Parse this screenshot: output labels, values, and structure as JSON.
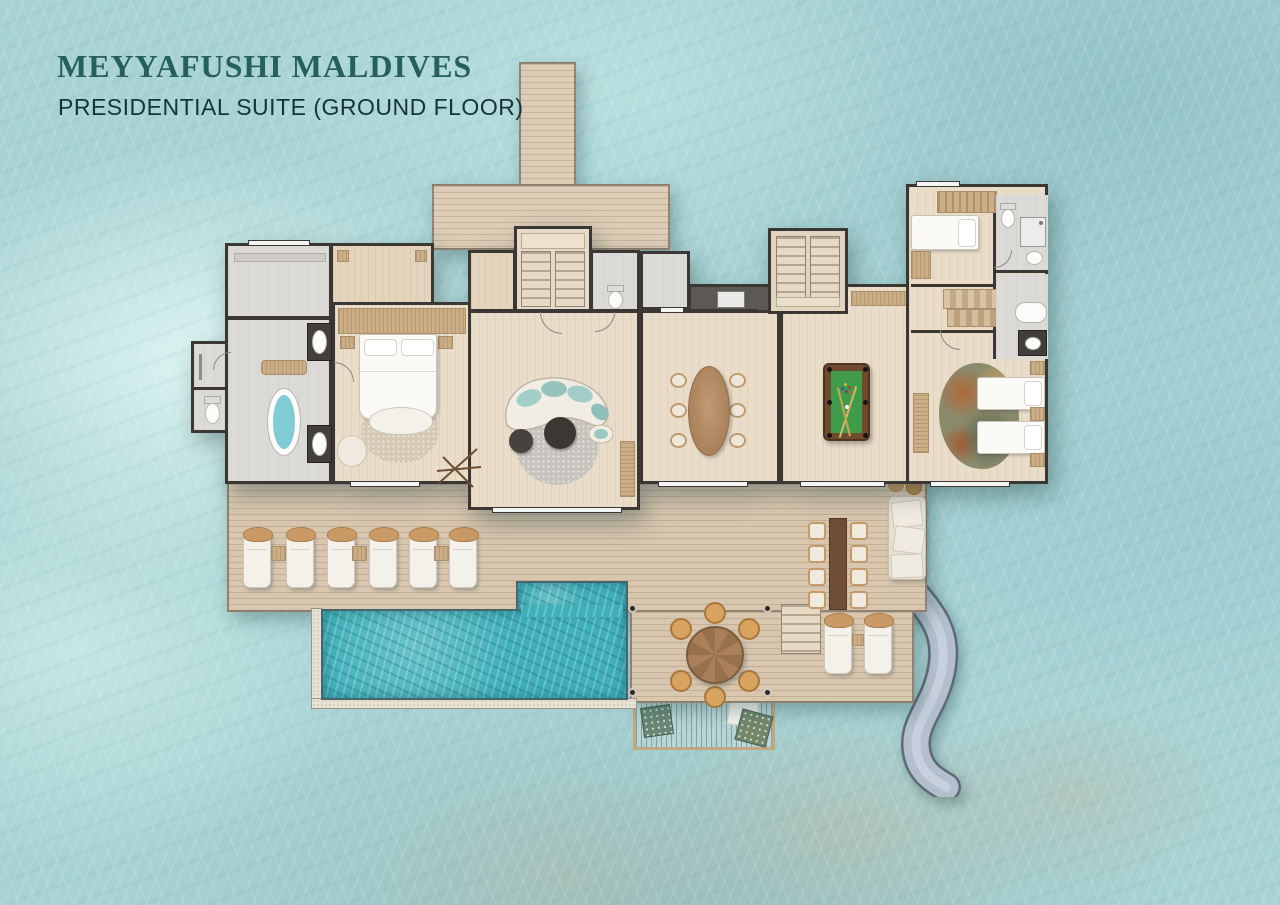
{
  "header": {
    "title": "MEYYAFUSHI MALDIVES",
    "subtitle": "PRESIDENTIAL SUITE (GROUND FLOOR)"
  },
  "palette": {
    "title_teal": "#26605a",
    "subtitle_ink": "#16323a",
    "water": "#a7d2d4",
    "water_light": "#d6efec",
    "water_deep": "#8fc0c4",
    "sand_patch": "#c6c0aa",
    "deck_wood": "#d8c6af",
    "wall": "#3a3734",
    "interior_wood": "#e9dcc8",
    "interior_stone": "#dbdad7",
    "pool_water": "#3fb0ba",
    "pool_tile": "#e9e2d2",
    "billiard_felt": "#3f9b49",
    "slide_gray": "#b4bfcd",
    "lounger_white": "#f4f1ea",
    "accent_tan": "#c99a66"
  },
  "plan": {
    "features": [
      "jetty-walkway",
      "arrival-deck",
      "entry-stairs",
      "master-dressing-room",
      "master-bathroom",
      "freestanding-bathtub",
      "double-vanity",
      "guest-wc",
      "walk-in-closet",
      "master-bedroom",
      "king-bed",
      "living-room",
      "curved-sofa",
      "powder-room",
      "dining-room",
      "dining-table-6-seats",
      "kitchen-pantry",
      "staircase",
      "games-room",
      "billiard-table",
      "junior-bedroom",
      "single-bed",
      "ensuite-bathroom",
      "family-bathroom",
      "twin-bedroom",
      "twin-beds",
      "sun-deck",
      "sun-loungers",
      "swimming-pool",
      "outdoor-dining-table-8-seats",
      "outdoor-lounge-sofa",
      "round-deck-dining-table",
      "deck-steps",
      "overwater-net-hammock",
      "water-slide",
      "deck-loungers"
    ]
  }
}
